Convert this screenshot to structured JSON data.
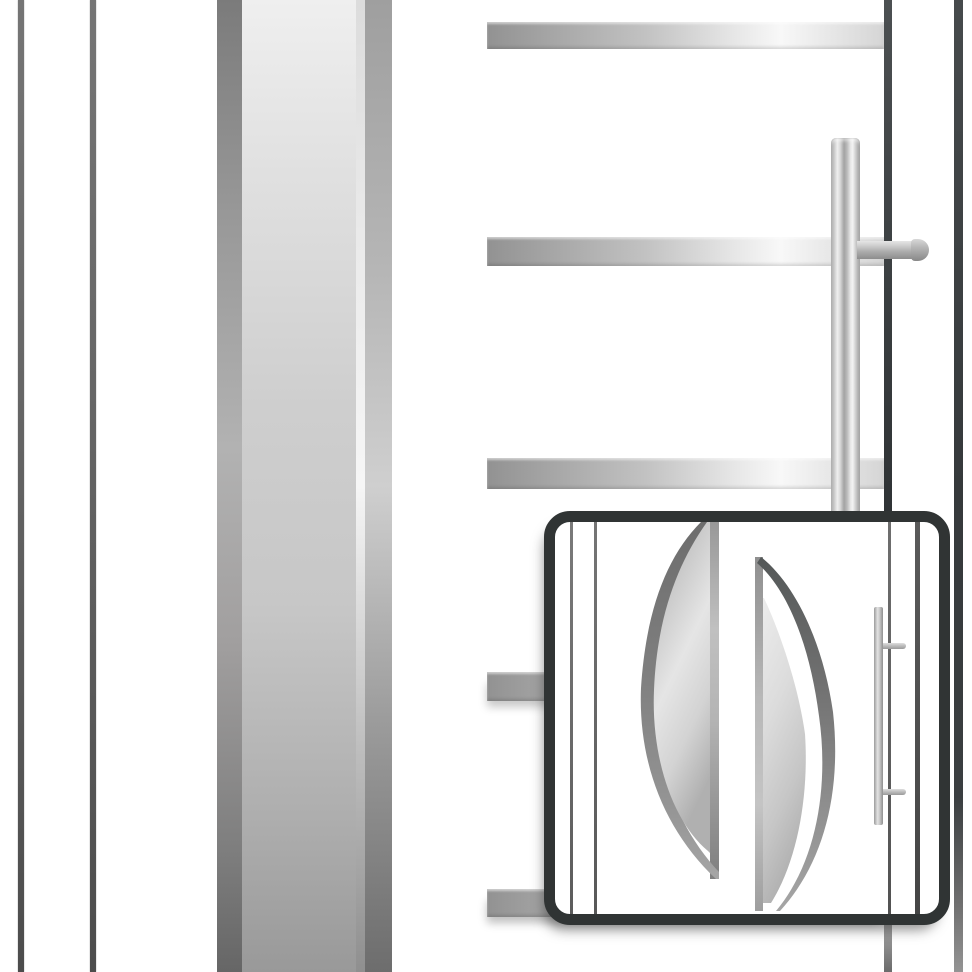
{
  "viewer": {
    "description": "Magnified detail view of a white entry door with stainless-steel design elements",
    "inset_description": "Full door design preview thumbnail with curved glass motifs and bar handle",
    "visible_text": ""
  },
  "colors": {
    "background": "#ffffff",
    "inset_border": "#303434",
    "edge_line_dark": "#3a3e40",
    "steel_highlight": "#f8f8f8",
    "steel_mid": "#c9c9c9",
    "steel_shadow": "#8f8f8f"
  },
  "components": {
    "frame_lines_left": 2,
    "steel_pilaster": "vertical brushed stainless band",
    "application_bars": 5,
    "door_handle": "vertical stainless bar handle with round mounting bolt",
    "edge_lines_right": 2,
    "preview_inset": {
      "glass_motif_left": "large leaf-shaped lens, flat right edge",
      "glass_motif_right": "crescent leaf with white sliver, flat left edge",
      "thumb_handle": "bar handle with two mounts",
      "thumb_frame_lines": 4
    }
  }
}
